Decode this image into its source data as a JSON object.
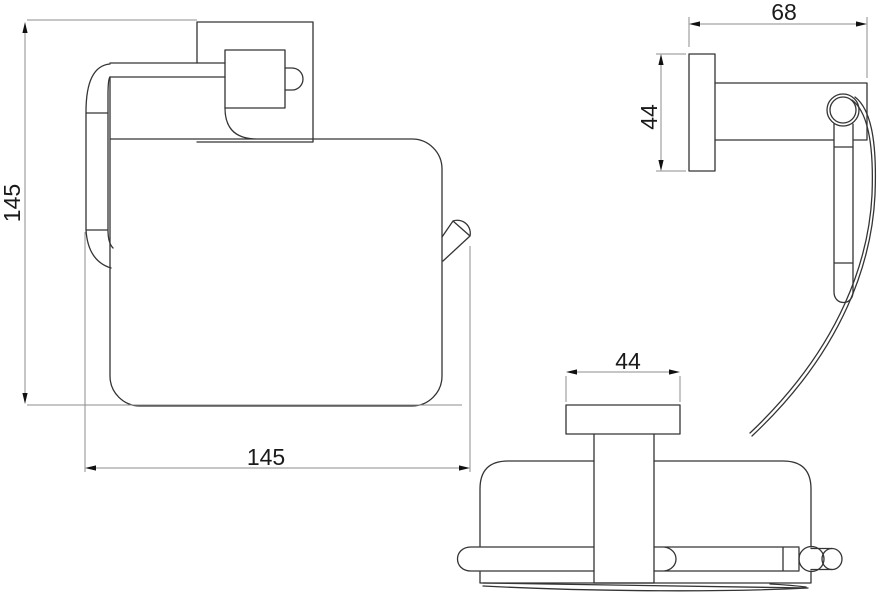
{
  "drawing": {
    "views": {
      "front": {
        "height_mm": "145",
        "width_mm": "145"
      },
      "side": {
        "depth_mm": "68",
        "plate_height_mm": "44"
      },
      "top": {
        "plate_width_mm": "44"
      }
    },
    "colors": {
      "background": "#ffffff",
      "object_line": "#343434",
      "dimension_line": "#8c8c8c",
      "arrow": "#111111",
      "text": "#1a1a1a"
    }
  }
}
